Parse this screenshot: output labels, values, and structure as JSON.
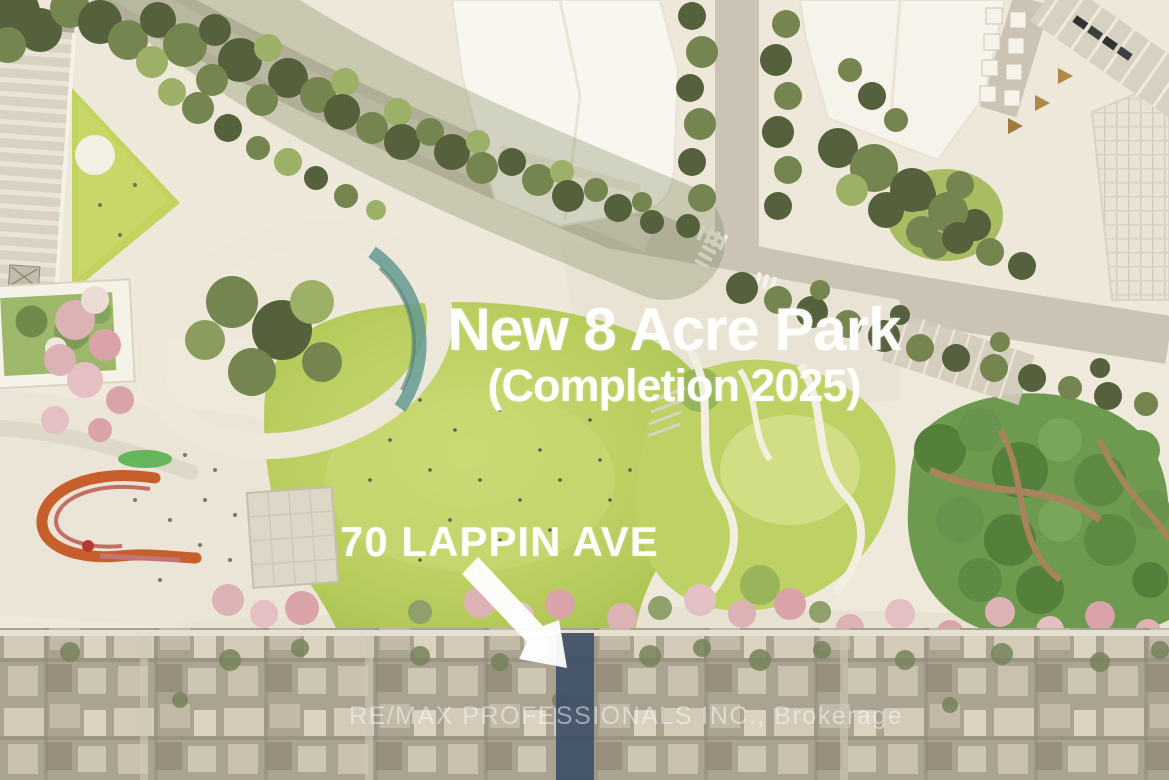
{
  "scene": {
    "type": "architectural-aerial-site-plan-rendering",
    "title": "New 8 Acre Park",
    "subtitle": "(Completion 2025)",
    "address_label": "70 LAPPIN AVE",
    "watermark": "RE/MAX PROFESSIONALS INC., Brokerage"
  },
  "icons": {
    "arrow": "arrow-down-right-icon"
  },
  "palette": {
    "overlay_text": "#ffffff",
    "lawn_green": "#b9ce5f",
    "canopy_dark_green": "#55603c",
    "grove_green": "#6e9a50",
    "blossom_pink": "#ddb2b5",
    "play_ribbon_orange": "#c75f2c",
    "water_teal": "#649a90",
    "road_grey": "#cbc4b4",
    "plaza_cream": "#ece7d9",
    "building_white": "#f8f6ef",
    "aerial_strip_taupe": "#b0a997",
    "highlight_lot_navy": "#3d5068"
  }
}
